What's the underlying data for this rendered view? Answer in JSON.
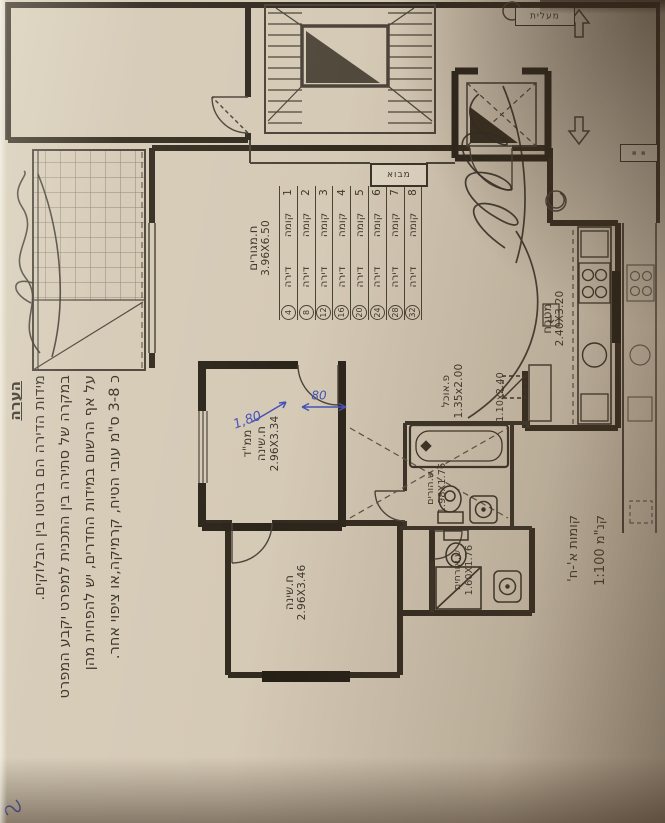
{
  "photo": {
    "paper_color": "#d5cab6",
    "ink_color": "#3a3328",
    "blue_ink": "#4753b8"
  },
  "note": {
    "heading": "הערה",
    "lines": [
      "מידות הדירה הם ברוטו בין הבלוקים.",
      "במקרה של סתירה בין התכנית למפרט יקבע המפרט",
      "על אף הרשום במידות החדרים, יש להפחית מהן",
      "כ 3-8 ס\"מ עובי הטיח, קרמיקה,או ציפוי אחר."
    ]
  },
  "scale": {
    "floors": "קומות א'-ח'",
    "ratio": "קנ\"מ 1:100"
  },
  "rooms": {
    "living": {
      "name": "ח.מגורים",
      "dims": "3.96X6.50"
    },
    "mamad": {
      "name": "ממ\"ד",
      "name2": "ח.שינה",
      "dims": "2.96X3.34"
    },
    "bedroom": {
      "name": "ח.שינה",
      "dims": "2.96X3.46"
    },
    "kitchen": {
      "name": "מטבח",
      "dims": "2.40X3.20"
    },
    "dining": {
      "name": "פ.אוכל",
      "dims": "1.35x2.00"
    },
    "passage": {
      "dims": "1.10x2.40"
    },
    "bath_parents": {
      "name": "ש.הורים",
      "dims": "1.98X1.76"
    },
    "bath_guests": {
      "name": "ש.אורחים",
      "dims": "1.60X1.76"
    },
    "lobby": {
      "name": "מבוא"
    },
    "elevator": {
      "name": "מעלית"
    }
  },
  "floor_table": {
    "floor_word": "קומה",
    "apt_word": "דירה",
    "rows": [
      {
        "floor": "1",
        "apt": "4"
      },
      {
        "floor": "2",
        "apt": "8"
      },
      {
        "floor": "3",
        "apt": "12"
      },
      {
        "floor": "4",
        "apt": "16"
      },
      {
        "floor": "5",
        "apt": "20"
      },
      {
        "floor": "6",
        "apt": "24"
      },
      {
        "floor": "7",
        "apt": "28"
      },
      {
        "floor": "8",
        "apt": "32"
      }
    ]
  },
  "annotations": {
    "dim_long": "1,80",
    "dim_short": "80"
  }
}
